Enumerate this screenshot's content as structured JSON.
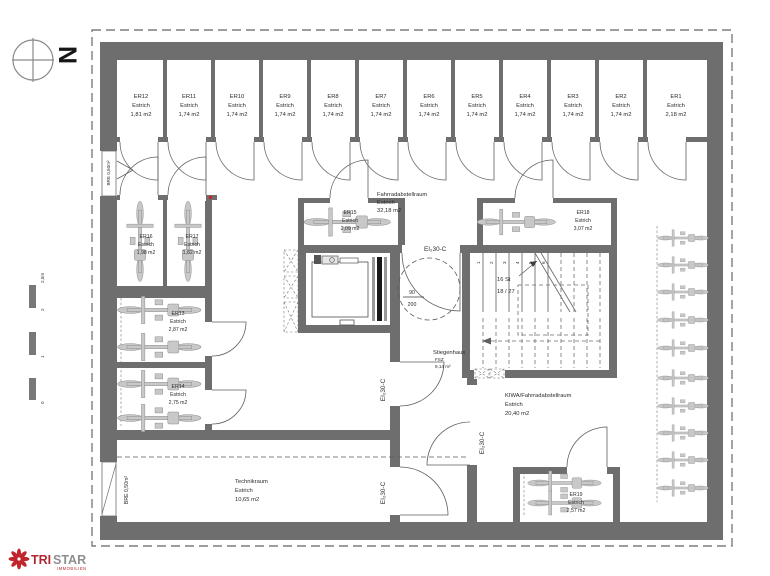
{
  "plan": {
    "top_rooms": [
      {
        "id": "ER12",
        "material": "Estrich",
        "area": "1,81 m2"
      },
      {
        "id": "ER11",
        "material": "Estrich",
        "area": "1,74 m2"
      },
      {
        "id": "ER10",
        "material": "Estrich",
        "area": "1,74 m2"
      },
      {
        "id": "ER9",
        "material": "Estrich",
        "area": "1,74 m2"
      },
      {
        "id": "ER8",
        "material": "Estrich",
        "area": "1,74 m2"
      },
      {
        "id": "ER7",
        "material": "Estrich",
        "area": "1,74 m2"
      },
      {
        "id": "ER6",
        "material": "Estrich",
        "area": "1,74 m2"
      },
      {
        "id": "ER5",
        "material": "Estrich",
        "area": "1,74 m2"
      },
      {
        "id": "ER4",
        "material": "Estrich",
        "area": "1,74 m2"
      },
      {
        "id": "ER3",
        "material": "Estrich",
        "area": "1,74 m2"
      },
      {
        "id": "ER2",
        "material": "Estrich",
        "area": "1,74 m2"
      },
      {
        "id": "ER1",
        "material": "Estrich",
        "area": "2,18 m2"
      }
    ],
    "rooms": {
      "er16": {
        "id": "ER16",
        "material": "Estrich",
        "area": "1,98 m2"
      },
      "er17": {
        "id": "ER17",
        "material": "Estrich",
        "area": "1,82 m2"
      },
      "er13": {
        "id": "ER13",
        "material": "Estrich",
        "area": "2,87 m2"
      },
      "er14": {
        "id": "ER14",
        "material": "Estrich",
        "area": "2,75 m2"
      },
      "er15": {
        "id": "ER15",
        "material": "Estrich",
        "area": "2,09 m2"
      },
      "er18": {
        "id": "ER18",
        "material": "Estrich",
        "area": "3,07 m2"
      },
      "er19": {
        "id": "ER19",
        "material": "Estrich",
        "area": "2,57 m2"
      }
    },
    "areas": {
      "bike_room": {
        "name": "Fahrradabstellraum",
        "material": "Estrich",
        "area": "32,18 m2"
      },
      "kiwa_room": {
        "name": "KIWA/Fahrradabstellraum",
        "material": "Estrich",
        "area": "20,40 m2"
      },
      "technik_room": {
        "name": "Technikraum",
        "material": "Estrich",
        "area": "10,65 m2"
      },
      "stairwell": {
        "name": "Stiegenhaus",
        "code": "FSZ",
        "area": "9,14 m²"
      }
    },
    "labels": {
      "fire_rating": "EI₂30-C",
      "bre_shaft": "BRE 0,50m²",
      "lift_width": "90",
      "lift_depth": "200",
      "stair_count": "16 St",
      "stair_ratio": "18 / 27",
      "stair_steps": [
        "1",
        "2",
        "3",
        "4",
        "5",
        "6"
      ]
    }
  },
  "compass": {
    "north": "N"
  },
  "scalebar": {
    "m0": "0",
    "m1": "1",
    "m2": "2",
    "m25": "2,5m"
  },
  "logo": {
    "brand_primary": "TRI",
    "brand_secondary": "STAR",
    "tagline": "IMMOBILIEN"
  },
  "colors": {
    "wall": "#6e6e6e",
    "accent_red": "#c0262c"
  }
}
